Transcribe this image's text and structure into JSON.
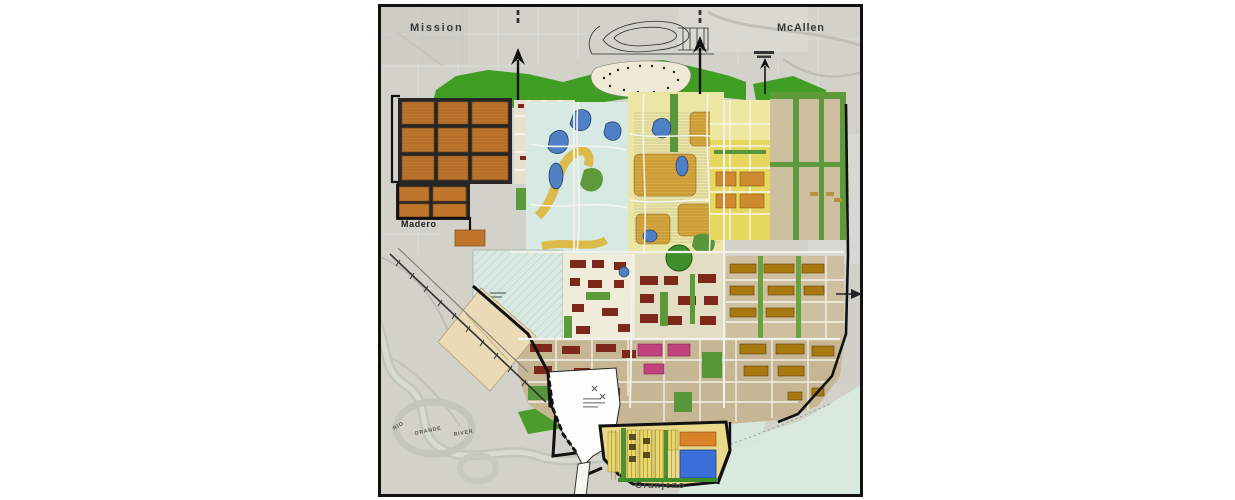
{
  "map": {
    "labels": {
      "mission": "Mission",
      "mcallen": "McAllen",
      "madero": "Madero",
      "granjeno": "Granjeno",
      "river_words": [
        "RIO",
        "GRANDE",
        "RIVER"
      ]
    },
    "palette": {
      "aerial_base": "#d2d2ca",
      "aerial_patch": "#c8c8c0",
      "river_gray": "#c3c6bb",
      "greenway_green": "#3f9e23",
      "park_green": "#5d9a3a",
      "residential_orange": "#bf762c",
      "residential_gold": "#d7a83e",
      "residential_yellow": "#e6d75e",
      "pale_yellow": "#ebe5a6",
      "cream": "#e7e2cf",
      "lake_pale_cyan": "#d6e9e3",
      "pond_blue": "#4f7fc4",
      "future_tan": "#cdbf9f",
      "south_tan": "#c6b693",
      "commercial_dark_red": "#7e281c",
      "mixed_magenta": "#c2417f",
      "industrial_gold": "#a8790f",
      "seafoam_hatched": "#d9e8e0",
      "mint_floodplain": "#d9e9de",
      "parchment": "#eadbb6",
      "school_blue": "#3a6fd8",
      "stripe_yellow": "#e8d76a",
      "bridge_white": "#fdfdfb",
      "road_black": "#1a1a1a",
      "road_white": "#f2f2ea"
    }
  }
}
